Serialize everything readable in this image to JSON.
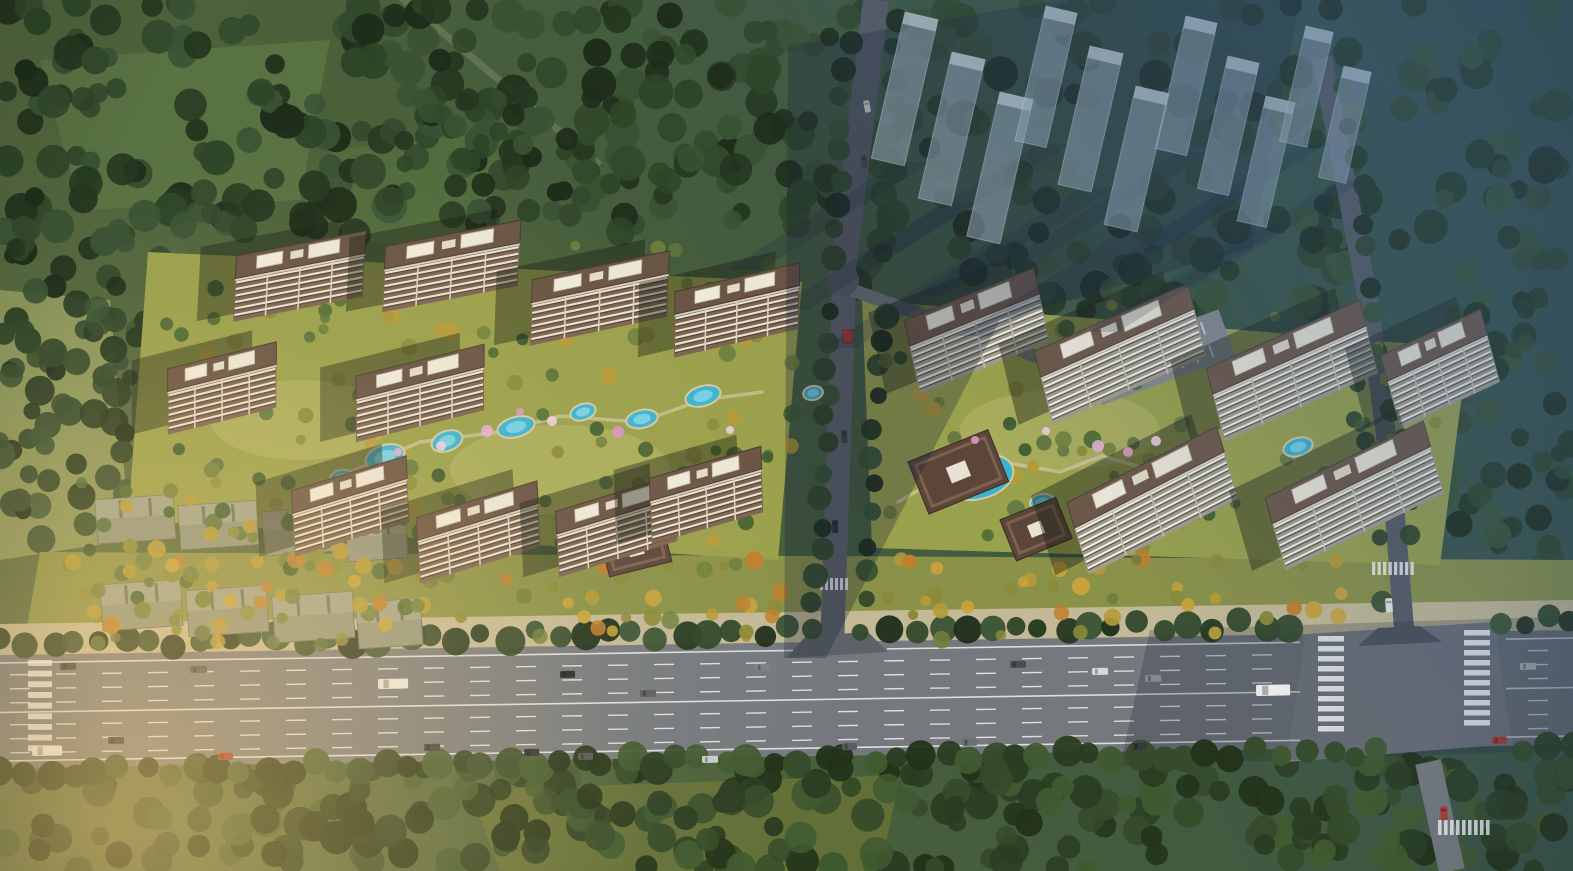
{
  "canvas": {
    "w": 1573,
    "h": 871,
    "seed": 20240517
  },
  "palette": {
    "baseA": "#5c6c40",
    "baseB": "#49603a",
    "baseC": "#35504a",
    "asphalt": "#75797e",
    "asphaltLight": "#7e8287",
    "asphaltShadow": "#565b63",
    "roadMinor": "#5d6269",
    "roadBranch": "#6e7277",
    "sidewalk": "#c4b996",
    "laneWhite": "rgba(255,255,255,0.75)",
    "poolFill": "#3eb3cf",
    "poolInner": "#85d7e7",
    "poolEdge": "#d5c9a5",
    "lawnLeft": "#9aa04b",
    "lawnRight": "#99a14c",
    "lawnBand": "#8a9148",
    "meadowA": "#5a7342",
    "meadowB": "#516b3c",
    "meadowC": "#8d985c",
    "meadowS": "#647138",
    "gateRed": "#c23b2e",
    "ghostFill": "rgba(158,175,190,0.52)",
    "ghostStroke": "rgba(215,225,235,0.4)",
    "ghostRoof": "rgba(230,238,245,0.5)",
    "ghostShadow": "rgba(24,38,58,0.2)",
    "bandShadow": "rgba(26,38,56,0.3)",
    "bandShadow2": "rgba(26,38,56,0.2)",
    "pavRoof": "#5c463a",
    "pavEdge": "#3f302a",
    "pavRidge": "#7c614d",
    "pavSky": "#e8e2d4",
    "slabFill": "#8f957e",
    "slabEdge": "#6d7260",
    "slabRoof": "#a5aa92",
    "parking": "#87898d",
    "pathTan": "#d9cfae",
    "hazeColor": "58,92,132",
    "glowColor": "255,206,120",
    "warmColor": "255,226,168",
    "towerLeft": {
      "facade": "#7e6450",
      "stripeLight": "#e9e2d1",
      "stripeDark": "#4e453c",
      "divider": "#d9d2c0",
      "roof": "#6a5444",
      "roofEdge": "#4a3a30",
      "parapet": "#d8d1c0",
      "shadow": "rgba(25,32,22,0.42)",
      "F": 40,
      "R": 22,
      "skew": -14
    },
    "towerRight": {
      "facade": "#a39c8c",
      "stripeLight": "#f4f0e3",
      "stripeDark": "#57534b",
      "divider": "#c8c2b2",
      "roof": "#6e5748",
      "roofEdge": "#4e4036",
      "parapet": "#ddd6c6",
      "shadow": "rgba(25,32,22,0.42)",
      "F": 46,
      "R": 26,
      "skew": -10
    },
    "treeDark": [
      "#243720",
      "#2e4527",
      "#395233",
      "#1e2d1a",
      "#33492c"
    ],
    "treeMixed": [
      "#3c5a2e",
      "#4f6b35",
      "#5d7340",
      "#6f7f3d",
      "#8a8a3a",
      "#b69a38"
    ],
    "treeGold": [
      "#8a8a3a",
      "#b69a38",
      "#c8a33c",
      "#bf7f2e",
      "#6f7f3d"
    ],
    "treeSouth": [
      "#2a3d22",
      "#354b29",
      "#405a30",
      "#223319"
    ],
    "blossom": [
      "#e3aed0",
      "#d897c2",
      "#eecde2"
    ]
  },
  "forest": [
    {
      "r": [
        0,
        0,
        850,
        235
      ],
      "n": 240,
      "pal": "treeDark",
      "rad": [
        9,
        18
      ]
    },
    {
      "r": [
        0,
        225,
        160,
        330
      ],
      "n": 80,
      "pal": "treeDark",
      "rad": [
        8,
        15
      ]
    },
    {
      "r": [
        855,
        0,
        718,
        310
      ],
      "n": 170,
      "pal": "treeDark",
      "rad": [
        9,
        18
      ]
    },
    {
      "r": [
        1445,
        300,
        128,
        345
      ],
      "n": 55,
      "pal": "treeDark",
      "rad": [
        8,
        14
      ]
    },
    {
      "r": [
        0,
        760,
        1573,
        111
      ],
      "n": 270,
      "pal": "treeSouth",
      "rad": [
        9,
        17
      ]
    },
    {
      "r": [
        390,
        95,
        210,
        120
      ],
      "n": 40,
      "pal": "treeDark",
      "rad": [
        8,
        14
      ]
    }
  ],
  "meadows": [
    {
      "pts": [
        [
          40,
          60
        ],
        [
          330,
          40
        ],
        [
          300,
          200
        ],
        [
          80,
          210
        ]
      ],
      "fill": "meadowA"
    },
    {
      "pts": [
        [
          330,
          150
        ],
        [
          520,
          130
        ],
        [
          470,
          250
        ],
        [
          340,
          240
        ]
      ],
      "fill": "meadowB"
    },
    {
      "pts": [
        [
          0,
          290
        ],
        [
          110,
          300
        ],
        [
          130,
          540
        ],
        [
          0,
          560
        ]
      ],
      "fill": "meadowC"
    },
    {
      "pts": [
        [
          470,
          790
        ],
        [
          900,
          775
        ],
        [
          880,
          871
        ],
        [
          500,
          871
        ]
      ],
      "fill": "meadowS"
    }
  ],
  "diagPath": {
    "from": [
      392,
      -10
    ],
    "to": [
      600,
      165
    ]
  },
  "grounds": {
    "left": [
      [
        148,
        252
      ],
      [
        802,
        282
      ],
      [
        778,
        560
      ],
      [
        128,
        520
      ]
    ],
    "right": [
      [
        862,
        300
      ],
      [
        1468,
        348
      ],
      [
        1440,
        565
      ],
      [
        872,
        548
      ]
    ],
    "lawnBand": [
      [
        40,
        552
      ],
      [
        1573,
        560
      ],
      [
        1573,
        640
      ],
      [
        24,
        644
      ]
    ],
    "sidewalk": [
      [
        0,
        624
      ],
      [
        1573,
        600
      ],
      [
        1573,
        632
      ],
      [
        0,
        657
      ]
    ]
  },
  "paths": {
    "left": [
      [
        350,
        472
      ],
      [
        420,
        442
      ],
      [
        500,
        432
      ],
      [
        560,
        416
      ],
      [
        640,
        422
      ],
      [
        702,
        400
      ],
      [
        762,
        392
      ]
    ],
    "right": [
      [
        898,
        502
      ],
      [
        950,
        472
      ],
      [
        1002,
        462
      ],
      [
        1060,
        472
      ],
      [
        1102,
        456
      ],
      [
        1150,
        470
      ]
    ]
  },
  "highway": {
    "top": [
      [
        0,
        655
      ],
      [
        1573,
        630
      ]
    ],
    "bot": [
      [
        0,
        768
      ],
      [
        1573,
        745
      ]
    ],
    "solidOffsets": [
      8,
      57.5,
      106
    ],
    "dashOffsets": [
      20,
      34,
      48,
      70,
      84,
      98
    ],
    "solidSegsTop": [
      [
        0,
        793
      ],
      [
        887,
        1300
      ],
      [
        1506,
        1573
      ]
    ],
    "solidSegsMid": [
      [
        0,
        1300
      ],
      [
        1506,
        1573
      ]
    ],
    "dashSkip": [
      [
        1295,
        1505
      ]
    ],
    "intersection": [
      [
        1306,
        634
      ],
      [
        1494,
        622
      ],
      [
        1512,
        744
      ],
      [
        1286,
        762
      ]
    ],
    "flareCenter": [
      [
        786,
        658
      ],
      [
        806,
        636
      ],
      [
        868,
        632
      ],
      [
        888,
        652
      ]
    ],
    "flareEast": [
      [
        1358,
        646
      ],
      [
        1378,
        628
      ],
      [
        1420,
        626
      ],
      [
        1442,
        642
      ]
    ],
    "shadowOverlay": [
      [
        1150,
        630
      ],
      [
        1573,
        616
      ],
      [
        1573,
        750
      ],
      [
        1120,
        766
      ]
    ]
  },
  "zebras": [
    [
      1318,
      636,
      26,
      100,
      10,
      "h"
    ],
    [
      1464,
      630,
      26,
      100,
      10,
      "h"
    ],
    [
      1372,
      562,
      44,
      13,
      8,
      "v"
    ],
    [
      1438,
      820,
      54,
      15,
      9,
      "v"
    ],
    [
      28,
      660,
      24,
      96,
      9,
      "h"
    ],
    [
      820,
      578,
      30,
      12,
      6,
      "v"
    ]
  ],
  "roads": {
    "north1": {
      "d": [
        [
          876,
          0
        ],
        [
          842,
          276
        ]
      ],
      "w": 26,
      "col": "asphaltShadow"
    },
    "north2": {
      "d": [
        [
          844,
          284
        ],
        [
          832,
          648
        ]
      ],
      "w": 24,
      "col": "roadMinor"
    },
    "branch": {
      "d": [
        [
          852,
          290
        ],
        [
          1020,
          350
        ],
        [
          1122,
          392
        ]
      ],
      "w": 13,
      "col": "roadBranch"
    },
    "east": {
      "d": [
        [
          1322,
          58
        ],
        [
          1368,
          300
        ],
        [
          1392,
          480
        ],
        [
          1404,
          628
        ]
      ],
      "w": 20,
      "col": "asphaltShadow"
    },
    "south": {
      "d": [
        [
          1428,
          762
        ],
        [
          1452,
          871
        ]
      ],
      "w": 26,
      "col": "asphalt"
    },
    "junction": [
      843,
      280,
      16
    ]
  },
  "treeRows": [
    {
      "from": [
        0,
        644
      ],
      "to": [
        1573,
        620
      ],
      "step": 25,
      "jit": 6,
      "rad": [
        9,
        15
      ],
      "pal": "treeDark",
      "gaps": [
        [
          792,
          884
        ],
        [
          1308,
          1496
        ]
      ],
      "axis": "x"
    },
    {
      "from": [
        0,
        772
      ],
      "to": [
        1573,
        748
      ],
      "step": 24,
      "jit": 6,
      "rad": [
        10,
        16
      ],
      "pal": "treeSouth",
      "gaps": [
        [
          1402,
          1505
        ]
      ],
      "axis": "x"
    },
    {
      "from": [
        848,
        20
      ],
      "to": [
        814,
        632
      ],
      "step": 26,
      "jit": 5,
      "rad": [
        8,
        13
      ],
      "pal": "treeDark",
      "gaps": [
        [
          270,
          305
        ]
      ],
      "axis": "y"
    },
    {
      "from": [
        898,
        20
      ],
      "to": [
        864,
        632
      ],
      "step": 28,
      "jit": 5,
      "rad": [
        8,
        13
      ],
      "pal": "treeDark",
      "gaps": [
        [
          268,
          310
        ]
      ],
      "axis": "y"
    },
    {
      "from": [
        1306,
        80
      ],
      "to": [
        1384,
        600
      ],
      "step": 30,
      "jit": 6,
      "rad": [
        8,
        12
      ],
      "pal": "treeDark",
      "gaps": [
        [
          540,
          600
        ]
      ],
      "axis": "y"
    },
    {
      "from": [
        1342,
        60
      ],
      "to": [
        1420,
        600
      ],
      "step": 32,
      "jit": 6,
      "rad": [
        8,
        12
      ],
      "pal": "treeDark",
      "gaps": [
        [
          540,
          600
        ]
      ],
      "axis": "y"
    }
  ],
  "slabs": [
    [
      95,
      500,
      78,
      44
    ],
    [
      178,
      506,
      78,
      44
    ],
    [
      262,
      512,
      78,
      44
    ],
    [
      345,
      518,
      60,
      44
    ],
    [
      100,
      585,
      80,
      46
    ],
    [
      186,
      591,
      80,
      46
    ],
    [
      272,
      597,
      80,
      46
    ],
    [
      356,
      603,
      64,
      46
    ]
  ],
  "slabTrees": {
    "r": [
      75,
      462,
      350,
      185
    ],
    "n": 60,
    "pal": "treeMixed",
    "rad": [
      5,
      9
    ]
  },
  "parking": {
    "x": 1085,
    "y": 358,
    "w": 142,
    "h": 50,
    "rot": -20,
    "cars": [
      [
        "#d9d9d6",
        12
      ],
      [
        "#3a3d41",
        46
      ],
      [
        "#8a8d91",
        96
      ]
    ]
  },
  "compoundTrees": [
    {
      "r": [
        165,
        245,
        630,
        300
      ],
      "n": 95,
      "pal": "treeMixed",
      "rad": [
        5,
        9
      ]
    },
    {
      "r": [
        875,
        305,
        570,
        245
      ],
      "n": 85,
      "pal": "treeMixed",
      "rad": [
        5,
        9
      ]
    },
    {
      "r": [
        55,
        555,
        1390,
        85
      ],
      "n": 120,
      "pal": "treeGold",
      "rad": [
        5,
        9
      ],
      "avoid": [
        [
          795,
          880
        ],
        [
          1355,
          1445
        ]
      ]
    }
  ],
  "pools": [
    [
      385,
      457,
      20,
      12,
      -18
    ],
    [
      447,
      441,
      16,
      10,
      -20
    ],
    [
      516,
      427,
      19,
      10,
      -15
    ],
    [
      583,
      412,
      13,
      8,
      -18
    ],
    [
      642,
      419,
      16,
      9,
      -12
    ],
    [
      703,
      396,
      18,
      10,
      -16
    ],
    [
      341,
      477,
      11,
      7,
      -14
    ],
    [
      813,
      393,
      10,
      7,
      -10
    ],
    [
      978,
      477,
      36,
      22,
      -14
    ],
    [
      948,
      460,
      15,
      10,
      -20
    ],
    [
      1042,
      502,
      12,
      8,
      -12
    ],
    [
      1298,
      447,
      15,
      9,
      -16
    ]
  ],
  "pavilions": [
    [
      600,
      538,
      64,
      40,
      -14
    ],
    [
      908,
      462,
      86,
      56,
      -22
    ],
    [
      1000,
      520,
      60,
      44,
      -22
    ]
  ],
  "gate": {
    "x": 843,
    "y": 330,
    "w": 10,
    "h": 13
  },
  "towers": {
    "left": [
      [
        300,
        268,
        132,
        -11
      ],
      [
        452,
        258,
        138,
        -11
      ],
      [
        600,
        290,
        140,
        -12
      ],
      [
        737,
        302,
        128,
        -13
      ],
      [
        222,
        380,
        112,
        -14
      ],
      [
        420,
        385,
        132,
        -14
      ],
      [
        350,
        498,
        120,
        -17
      ],
      [
        478,
        524,
        126,
        -17
      ],
      [
        616,
        518,
        124,
        -17
      ],
      [
        706,
        487,
        116,
        -16
      ]
    ],
    "right": [
      [
        975,
        322,
        140,
        -22
      ],
      [
        1118,
        345,
        168,
        -24
      ],
      [
        1290,
        362,
        168,
        -24
      ],
      [
        1438,
        360,
        110,
        -25
      ],
      [
        1150,
        492,
        168,
        -27
      ],
      [
        1352,
        487,
        176,
        -26
      ]
    ]
  },
  "blossoms": [
    [
      441,
      446,
      5
    ],
    [
      487,
      431,
      6
    ],
    [
      552,
      421,
      5
    ],
    [
      618,
      432,
      6
    ],
    [
      398,
      452,
      4
    ],
    [
      520,
      412,
      4
    ],
    [
      1098,
      446,
      6
    ],
    [
      1128,
      452,
      5
    ],
    [
      1156,
      441,
      5
    ],
    [
      1046,
      431,
      4
    ],
    [
      975,
      440,
      4
    ],
    [
      730,
      430,
      4
    ]
  ],
  "vehicles": [
    [
      60,
      663,
      16,
      7,
      "#3c3f42",
      -1
    ],
    [
      190,
      666,
      17,
      7,
      "#52555a",
      -1
    ],
    [
      378,
      679,
      30,
      10,
      "#e9e9e6",
      -1
    ],
    [
      560,
      671,
      15,
      7,
      "#26282b",
      -1
    ],
    [
      640,
      690,
      16,
      7,
      "#595d62",
      -1
    ],
    [
      755,
      664,
      15,
      7,
      "#7d8287",
      -1
    ],
    [
      1010,
      661,
      16,
      7,
      "#4a4e53",
      -1
    ],
    [
      1092,
      668,
      16,
      7,
      "#d9d9d6",
      -1
    ],
    [
      1145,
      675,
      16,
      7,
      "#86898d",
      -1
    ],
    [
      1256,
      685,
      34,
      11,
      "#f1f1ee",
      -1
    ],
    [
      1520,
      663,
      16,
      7,
      "#9fa3a7",
      -1
    ],
    [
      32,
      746,
      30,
      10,
      "#f3f3f0",
      -1
    ],
    [
      108,
      737,
      16,
      7,
      "#303337",
      -1
    ],
    [
      218,
      753,
      15,
      7,
      "#a8342c",
      -1
    ],
    [
      424,
      744,
      16,
      7,
      "#3a3d41",
      -1
    ],
    [
      524,
      749,
      15,
      7,
      "#2c2f33",
      -1
    ],
    [
      578,
      753,
      15,
      7,
      "#515459",
      -1
    ],
    [
      702,
      756,
      16,
      7,
      "#c9cbcd",
      -1
    ],
    [
      842,
      743,
      15,
      7,
      "#5a5e63",
      -1
    ],
    [
      962,
      739,
      15,
      7,
      "#6b6f74",
      -1
    ],
    [
      1132,
      743,
      15,
      7,
      "#35383c",
      -1
    ],
    [
      1492,
      737,
      15,
      7,
      "#a23830",
      -1
    ],
    [
      1392,
      598,
      14,
      7,
      "#e8e8e5",
      86
    ],
    [
      1447,
      806,
      14,
      7,
      "#b23a32",
      86
    ],
    [
      838,
      520,
      13,
      6,
      "#2f3236",
      88
    ],
    [
      847,
      430,
      13,
      6,
      "#3f4246",
      88
    ],
    [
      869,
      100,
      12,
      6,
      "#d8d8d5",
      80
    ],
    [
      866,
      155,
      12,
      6,
      "#45484c",
      80
    ]
  ],
  "ghosts": {
    "slabs": [
      [
        905,
        12,
        34,
        150
      ],
      [
        952,
        52,
        34,
        150
      ],
      [
        1000,
        92,
        34,
        148
      ],
      [
        1046,
        6,
        32,
        138
      ],
      [
        1090,
        46,
        34,
        142
      ],
      [
        1136,
        86,
        34,
        142
      ],
      [
        1186,
        16,
        32,
        136
      ],
      [
        1228,
        56,
        32,
        136
      ],
      [
        1266,
        96,
        30,
        128
      ],
      [
        1306,
        26,
        28,
        118
      ],
      [
        1344,
        66,
        28,
        114
      ]
    ],
    "rot": 13,
    "bands": [
      [
        [
          788,
          46
        ],
        [
          1062,
          0
        ],
        [
          1000,
          320
        ],
        [
          826,
          658
        ],
        [
          784,
          658
        ]
      ],
      [
        [
          1062,
          0
        ],
        [
          1300,
          0
        ],
        [
          1252,
          248
        ],
        [
          1000,
          320
        ]
      ]
    ]
  }
}
